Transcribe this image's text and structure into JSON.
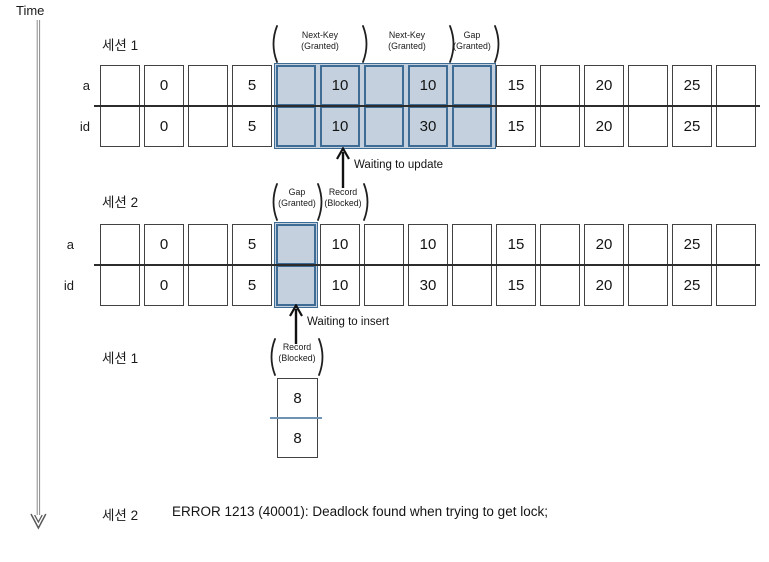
{
  "meta": {
    "time_label": "Time"
  },
  "row_labels": {
    "a": "a",
    "id": "id"
  },
  "session1_top": {
    "title": "세션 1",
    "locks": [
      {
        "line1": "Next-Key",
        "line2": "(Granted)"
      },
      {
        "line1": "Next-Key",
        "line2": "(Granted)"
      },
      {
        "line1": "Gap",
        "line2": "(Granted)"
      }
    ],
    "row_a": [
      "",
      "0",
      "",
      "5",
      "",
      "10",
      "",
      "10",
      "",
      "15",
      "",
      "20",
      "",
      "25",
      ""
    ],
    "row_id": [
      "",
      "0",
      "",
      "5",
      "",
      "10",
      "",
      "30",
      "",
      "15",
      "",
      "20",
      "",
      "25",
      ""
    ],
    "waiting": "Waiting to update"
  },
  "session2_mid": {
    "title": "세션 2",
    "locks": [
      {
        "line1": "Gap",
        "line2": "(Granted)"
      },
      {
        "line1": "Record",
        "line2": "(Blocked)"
      }
    ],
    "row_a": [
      "",
      "0",
      "",
      "5",
      "",
      "10",
      "",
      "10",
      "",
      "15",
      "",
      "20",
      "",
      "25",
      ""
    ],
    "row_id": [
      "",
      "0",
      "",
      "5",
      "",
      "10",
      "",
      "30",
      "",
      "15",
      "",
      "20",
      "",
      "25",
      ""
    ],
    "waiting": "Waiting to insert"
  },
  "session1_bottom": {
    "title": "세션 1",
    "lock": {
      "line1": "Record",
      "line2": "(Blocked)"
    },
    "insert_a": "8",
    "insert_id": "8"
  },
  "session2_bottom": {
    "title": "세션 2",
    "error": "ERROR 1213 (40001): Deadlock found when trying to get lock;"
  },
  "colors": {
    "highlight_fill": "#c4d0dd",
    "highlight_border": "#3f6c94",
    "cell_border": "#424242"
  }
}
